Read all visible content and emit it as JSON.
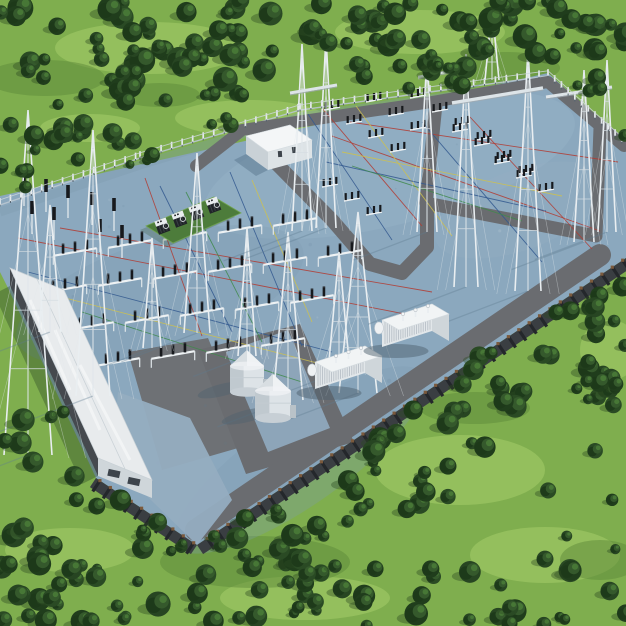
{
  "meta": {
    "description": "Aerial 3D render of an electrical power substation on a blue-grey pad surrounded by green forest",
    "width": 626,
    "height": 626
  },
  "palette": {
    "grass": "#7fae4e",
    "grass_light": "#a6ce69",
    "grass_dark": "#5d8a3a",
    "tree_dark": "#1d381a",
    "tree_base": "#274522",
    "tree_mid": "#35592c",
    "tree_hi": "#497a37",
    "tree_shadow": "#2e4a24",
    "pad": "#8ba8be",
    "pad_rim": "#bac7d0",
    "pad_shade": "#7e9bb0",
    "road": "#6a6c70",
    "apron_dark": "#6e7175",
    "apron_pale": "#95adc0",
    "tank_pad": "#8da5b9",
    "wall_band": "#3a3e42",
    "wall_post": "#24272b",
    "wall_cap": "#7b5a3d",
    "fence_post": "#e5eaec",
    "fence_rail": "#ccd6db",
    "white_struct": "#e8ebed",
    "struct_shade": "#cfd6da",
    "struct_dark": "#45494e",
    "mast": "#e9eef1",
    "mast_inner": "#dfe6ea",
    "guy": "#e3e9ec",
    "insulator": "#17191d",
    "beam": "#eef2f4",
    "cable_red": "#b23b32",
    "cable_yellow": "#cec14e",
    "cable_blue": "#33598f",
    "cable_green": "#3f8a4b",
    "shadow_pad": "#5e7b90",
    "shadow_grass": "#2f4d28",
    "green_pad": "#4d7c3b"
  },
  "terrain": {
    "light_patches": [
      [
        150,
        48,
        95,
        26
      ],
      [
        420,
        32,
        85,
        22
      ],
      [
        250,
        118,
        75,
        18
      ],
      [
        520,
        150,
        55,
        20
      ],
      [
        592,
        205,
        34,
        18
      ],
      [
        460,
        470,
        85,
        35
      ],
      [
        545,
        555,
        75,
        28
      ],
      [
        70,
        550,
        65,
        22
      ],
      [
        305,
        598,
        85,
        22
      ],
      [
        610,
        350,
        30,
        30
      ],
      [
        90,
        128,
        50,
        14
      ]
    ],
    "dark_patches": [
      [
        45,
        78,
        60,
        18
      ],
      [
        505,
        68,
        55,
        16
      ],
      [
        255,
        562,
        95,
        26
      ],
      [
        475,
        408,
        55,
        16
      ],
      [
        160,
        95,
        40,
        12
      ],
      [
        600,
        560,
        40,
        20
      ]
    ]
  },
  "forest_clusters": [
    [
      0,
      0,
      320,
      95,
      52,
      6,
      13,
      11
    ],
    [
      320,
      0,
      306,
      80,
      48,
      6,
      13,
      22
    ],
    [
      0,
      88,
      150,
      58,
      16,
      5,
      11,
      33
    ],
    [
      0,
      140,
      42,
      62,
      6,
      5,
      10,
      44
    ],
    [
      155,
      92,
      170,
      38,
      7,
      5,
      9,
      55
    ],
    [
      408,
      55,
      160,
      60,
      14,
      5,
      10,
      66
    ],
    [
      556,
      18,
      70,
      120,
      13,
      5,
      11,
      77
    ],
    [
      556,
      128,
      70,
      80,
      9,
      5,
      10,
      88
    ],
    [
      588,
      252,
      38,
      180,
      14,
      5,
      11,
      99
    ],
    [
      536,
      300,
      80,
      110,
      14,
      5,
      11,
      111
    ],
    [
      452,
      352,
      96,
      100,
      16,
      5,
      12,
      122
    ],
    [
      362,
      408,
      100,
      104,
      16,
      5,
      12,
      133
    ],
    [
      272,
      462,
      104,
      104,
      16,
      5,
      12,
      144
    ],
    [
      196,
      516,
      112,
      110,
      14,
      5,
      12,
      155
    ],
    [
      318,
      556,
      308,
      70,
      26,
      5,
      12,
      166
    ],
    [
      548,
      430,
      78,
      130,
      5,
      5,
      10,
      177
    ],
    [
      0,
      416,
      200,
      210,
      34,
      5,
      13,
      188
    ],
    [
      34,
      356,
      62,
      68,
      7,
      4,
      9,
      199
    ],
    [
      84,
      416,
      72,
      72,
      8,
      4,
      10,
      211
    ],
    [
      142,
      478,
      72,
      72,
      9,
      4,
      10,
      222
    ],
    [
      0,
      560,
      330,
      66,
      20,
      5,
      12,
      233
    ],
    [
      60,
      150,
      240,
      40,
      8,
      4,
      8,
      244
    ]
  ],
  "pad": {
    "polygon": [
      [
        0,
        196
      ],
      [
        548,
        73
      ],
      [
        626,
        142
      ],
      [
        626,
        258
      ],
      [
        197,
        545
      ],
      [
        96,
        478
      ],
      [
        8,
        288
      ],
      [
        0,
        272
      ]
    ],
    "nw_boundary": [
      [
        0,
        205
      ],
      [
        140,
        158
      ],
      [
        300,
        110
      ],
      [
        430,
        92
      ],
      [
        548,
        76
      ]
    ],
    "ne_boundary": [
      [
        548,
        76
      ],
      [
        624,
        144
      ]
    ],
    "tones": [
      [
        390,
        165,
        190,
        60,
        -14,
        "#a3bdd0",
        0.22
      ],
      [
        160,
        295,
        150,
        55,
        -18,
        "#7d9ab0",
        0.28
      ],
      [
        300,
        460,
        150,
        45,
        -35,
        "#7f9cb2",
        0.3
      ],
      [
        520,
        210,
        90,
        40,
        -20,
        "#96b0c3",
        0.25
      ]
    ],
    "speckle_count": 60
  },
  "aprons": [
    {
      "name": "building-forecourt",
      "points": [
        [
          128,
          352
        ],
        [
          208,
          338
        ],
        [
          252,
          444
        ],
        [
          162,
          470
        ]
      ],
      "fill": "#6e7175",
      "op": 1
    },
    {
      "name": "tank-apron",
      "points": [
        [
          198,
          350
        ],
        [
          300,
          324
        ],
        [
          354,
          442
        ],
        [
          246,
          474
        ]
      ],
      "fill": "#6a6c70",
      "op": 1
    }
  ],
  "aprons_late": [
    {
      "name": "south-taper",
      "points": [
        [
          118,
          392
        ],
        [
          190,
          418
        ],
        [
          232,
          500
        ],
        [
          197,
          545
        ],
        [
          112,
          462
        ]
      ],
      "fill": "#95adc0",
      "op": 0.95
    },
    {
      "name": "tank-pad",
      "points": [
        [
          226,
          352
        ],
        [
          288,
          330
        ],
        [
          330,
          428
        ],
        [
          268,
          452
        ]
      ],
      "fill": "#8da5b9",
      "op": 1
    }
  ],
  "roads": [
    {
      "d": [
        [
          196,
          166
        ],
        [
          242,
          130
        ],
        [
          432,
          102
        ],
        [
          548,
          82
        ],
        [
          624,
          146
        ]
      ],
      "w": 12
    },
    {
      "d": [
        [
          436,
          104
        ],
        [
          426,
          203
        ],
        [
          596,
          236
        ],
        [
          600,
          128
        ]
      ],
      "w": 13
    },
    {
      "d": [
        [
          265,
          152
        ],
        [
          332,
          220
        ],
        [
          370,
          264
        ],
        [
          402,
          273
        ],
        [
          427,
          247
        ],
        [
          427,
          205
        ]
      ],
      "w": 14
    },
    {
      "d": [
        [
          196,
          530
        ],
        [
          600,
          255
        ]
      ],
      "w": 22
    }
  ],
  "cables": [
    [
      18,
      238,
      425,
      318,
      "r"
    ],
    [
      60,
      228,
      432,
      292,
      "r"
    ],
    [
      145,
      178,
      202,
      336,
      "r"
    ],
    [
      322,
      108,
      422,
      226,
      "r"
    ],
    [
      350,
      122,
      618,
      162,
      "r"
    ],
    [
      470,
      117,
      592,
      249,
      "r"
    ],
    [
      332,
      136,
      600,
      231,
      "r"
    ],
    [
      42,
      292,
      352,
      372,
      "y"
    ],
    [
      252,
      180,
      312,
      322,
      "y"
    ],
    [
      356,
      106,
      452,
      236,
      "y"
    ],
    [
      342,
      152,
      562,
      196,
      "y"
    ],
    [
      28,
      272,
      332,
      352,
      "b"
    ],
    [
      160,
      186,
      232,
      332,
      "b"
    ],
    [
      230,
      172,
      302,
      346,
      "b"
    ],
    [
      326,
      162,
      546,
      211,
      "b"
    ],
    [
      422,
      122,
      542,
      262,
      "b"
    ],
    [
      308,
      114,
      392,
      240,
      "b"
    ],
    [
      82,
      312,
      302,
      382,
      "g"
    ],
    [
      186,
      192,
      262,
      342,
      "g"
    ],
    [
      352,
      166,
      522,
      221,
      "g"
    ]
  ],
  "bays": [
    [
      75,
      252
    ],
    [
      130,
      244
    ],
    [
      185,
      236
    ],
    [
      240,
      229
    ],
    [
      295,
      222
    ],
    [
      65,
      289
    ],
    [
      120,
      282
    ],
    [
      175,
      275
    ],
    [
      230,
      268
    ],
    [
      285,
      261
    ],
    [
      340,
      254
    ],
    [
      92,
      326
    ],
    [
      147,
      319
    ],
    [
      202,
      312
    ],
    [
      257,
      306
    ],
    [
      312,
      299
    ],
    [
      118,
      362
    ],
    [
      173,
      355
    ],
    [
      228,
      349
    ],
    [
      283,
      342
    ]
  ],
  "triples": [
    [
      332,
      108
    ],
    [
      354,
      122
    ],
    [
      376,
      136
    ],
    [
      398,
      150
    ],
    [
      374,
      100
    ],
    [
      396,
      114
    ],
    [
      418,
      128
    ],
    [
      418,
      96
    ],
    [
      440,
      110
    ],
    [
      462,
      124
    ],
    [
      484,
      138
    ],
    [
      460,
      130
    ],
    [
      482,
      144
    ],
    [
      504,
      158
    ],
    [
      526,
      172
    ],
    [
      502,
      162
    ],
    [
      524,
      176
    ],
    [
      546,
      190
    ],
    [
      330,
      185
    ],
    [
      352,
      199
    ],
    [
      374,
      213
    ]
  ],
  "deadends": [
    [
      24,
      186
    ],
    [
      46,
      192
    ],
    [
      68,
      198
    ],
    [
      32,
      214
    ],
    [
      54,
      220
    ],
    [
      92,
      205
    ],
    [
      114,
      211
    ],
    [
      100,
      232
    ],
    [
      122,
      238
    ]
  ],
  "masts": [
    [
      28,
      110,
      455,
      24
    ],
    [
      50,
      205,
      332,
      11
    ],
    [
      93,
      130,
      396,
      17
    ],
    [
      152,
      238,
      348,
      9
    ],
    [
      197,
      153,
      333,
      13
    ],
    [
      247,
      228,
      356,
      9
    ],
    [
      288,
      232,
      400,
      15
    ],
    [
      339,
      252,
      372,
      11
    ],
    [
      358,
      212,
      393,
      19
    ],
    [
      302,
      44,
      231,
      10
    ],
    [
      326,
      37,
      228,
      10
    ],
    [
      427,
      57,
      232,
      10
    ],
    [
      466,
      54,
      287,
      12
    ],
    [
      528,
      49,
      291,
      13
    ],
    [
      584,
      70,
      242,
      10
    ],
    [
      607,
      60,
      232,
      9
    ],
    [
      492,
      8,
      80,
      7
    ]
  ],
  "gantries": [
    [
      290,
      93,
      337,
      85,
      3
    ],
    [
      452,
      103,
      543,
      88,
      3.5
    ],
    [
      546,
      97,
      612,
      87,
      3
    ],
    [
      418,
      77,
      466,
      68,
      2.5
    ]
  ],
  "transformer_pad": {
    "polygon": [
      [
        146,
        226
      ],
      [
        214,
        197
      ],
      [
        241,
        213
      ],
      [
        173,
        243
      ]
    ],
    "units": [
      [
        163,
        228
      ],
      [
        180,
        221
      ],
      [
        197,
        214
      ],
      [
        214,
        207
      ]
    ],
    "unit_rotation": -20
  },
  "tanks": [
    {
      "cx": 247,
      "baseY": 392,
      "r": 17,
      "h": 26,
      "cone": 16
    },
    {
      "cx": 273,
      "baseY": 418,
      "r": 18,
      "h": 27,
      "cone": 17
    }
  ],
  "containers": {
    "L": [
      50,
      -16
    ],
    "W": [
      17,
      10
    ],
    "h": 27,
    "units": [
      [
        315,
        362
      ],
      [
        382,
        320
      ]
    ]
  },
  "warehouse": {
    "roof": [
      [
        10,
        268
      ],
      [
        64,
        290
      ],
      [
        152,
        480
      ],
      [
        98,
        458
      ]
    ],
    "sw_wall": [
      [
        10,
        268
      ],
      [
        98,
        458
      ],
      [
        98,
        476
      ],
      [
        10,
        286
      ]
    ],
    "ne_wall": [
      [
        64,
        290
      ],
      [
        152,
        480
      ],
      [
        152,
        496
      ],
      [
        64,
        306
      ]
    ],
    "end_wall": [
      [
        98,
        458
      ],
      [
        152,
        480
      ],
      [
        152,
        498
      ],
      [
        98,
        476
      ]
    ],
    "shadow": [
      [
        10,
        286
      ],
      [
        98,
        476
      ],
      [
        82,
        484
      ],
      [
        -6,
        294
      ]
    ],
    "streaks": [
      [
        30,
        300,
        70,
        390
      ],
      [
        55,
        330,
        100,
        430
      ],
      [
        80,
        365,
        130,
        460
      ]
    ]
  },
  "control_building": {
    "top": [
      [
        246,
        136
      ],
      [
        290,
        125
      ],
      [
        312,
        140
      ],
      [
        268,
        152
      ]
    ],
    "front": [
      [
        246,
        136
      ],
      [
        268,
        152
      ],
      [
        268,
        170
      ],
      [
        246,
        154
      ]
    ],
    "side": [
      [
        268,
        152
      ],
      [
        312,
        140
      ],
      [
        312,
        158
      ],
      [
        268,
        170
      ]
    ],
    "shadow": [
      [
        246,
        154
      ],
      [
        268,
        170
      ],
      [
        256,
        176
      ],
      [
        234,
        160
      ]
    ]
  },
  "fence": {
    "nw_spacing": 11,
    "ne_spacing": 9,
    "post_h": 6.8
  },
  "wall_edges": [
    [
      [
        626,
        258
      ],
      [
        197,
        545
      ]
    ],
    [
      [
        197,
        545
      ],
      [
        96,
        478
      ]
    ]
  ]
}
